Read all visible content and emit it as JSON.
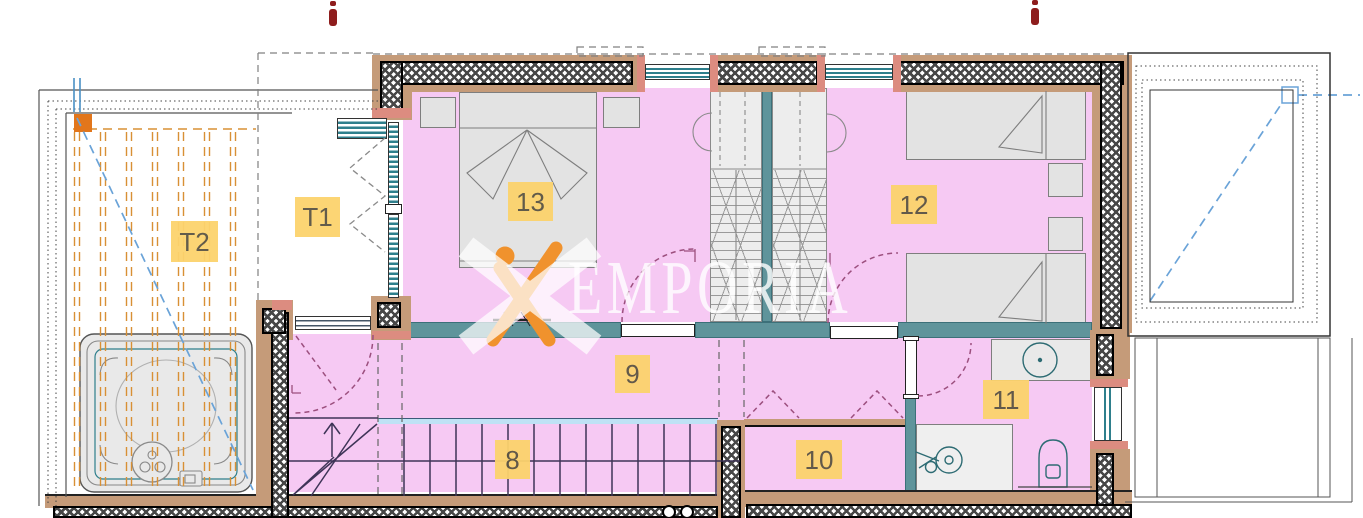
{
  "labels": {
    "t1": "T1",
    "t2": "T2",
    "r8": "8",
    "r9": "9",
    "r10": "10",
    "r11": "11",
    "r12": "12",
    "r13": "13"
  },
  "watermark": {
    "text": "EMPORIA"
  },
  "colors": {
    "pink": "#f6c9f3",
    "tan": "#c59b79",
    "salmon": "#dc8c80",
    "teal": "#5f949b",
    "glass": "#2e7f8c",
    "lblue": "#bfe2f5",
    "lbg": "#fcd36d",
    "ltxt": "#5b5442",
    "operg": "#d89035",
    "odeep": "#e2761b",
    "bluedash": "#6aa3d8",
    "purp": "#9c4f7e",
    "stairc": "#3e3457",
    "furn": "#e3e3e3",
    "furnb": "#7e7e7e",
    "worange": "#f0922d",
    "dred": "#8e1d1d"
  }
}
